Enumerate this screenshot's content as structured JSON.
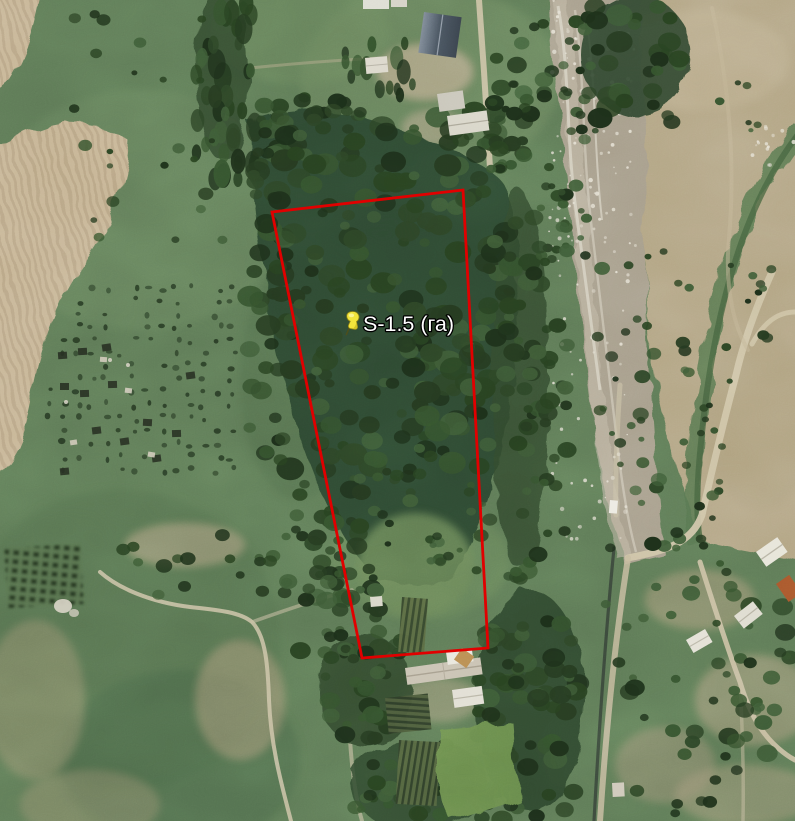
{
  "map": {
    "view": "satellite",
    "pin": {
      "label": "S-1.5 (га)",
      "icon": "yellow-pushpin",
      "color": "#f2e43c",
      "x": 352,
      "y": 320
    },
    "parcel": {
      "color": "#e10000",
      "stroke_width": 2.8,
      "vertices": [
        [
          272,
          212
        ],
        [
          463,
          190
        ],
        [
          488,
          648
        ],
        [
          362,
          658
        ]
      ]
    },
    "terrain_colors": {
      "scrub_green": "#5e7a56",
      "forest_green": "#2f4a30",
      "plowed_field_tan": "#c7b595",
      "riverbed_gray": "#a79e8b",
      "right_field_tan": "#b3a584",
      "road_tan": "#cdc2a4"
    }
  }
}
